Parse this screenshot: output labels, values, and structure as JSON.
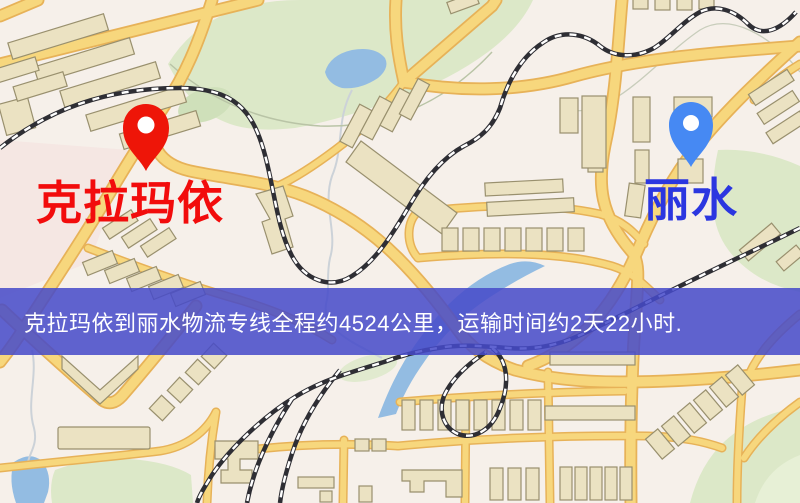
{
  "banner": {
    "text": "克拉玛依到丽水物流专线全程约4524公里，运输时间约2天22小时.",
    "bg_color": "#464aca",
    "text_color": "#ffffff"
  },
  "route": {
    "origin": "克拉玛依",
    "destination": "丽水",
    "distance_text": "约4524公里",
    "duration_text": "约2天22小时"
  },
  "pins": {
    "origin": {
      "label": "克拉玛依",
      "color": "#ee1508",
      "label_color": "#f20c0c"
    },
    "destination": {
      "label": "丽水",
      "color": "#4689f3",
      "label_color": "#2b36e0"
    }
  },
  "map_palette": {
    "background": "#f6f0ea",
    "park_green": "#dce8c8",
    "water_blue": "#93bce2",
    "road_fill": "#f7d77d",
    "road_casing": "#e7b258",
    "building_fill": "#ebe2c2",
    "building_stroke": "#99906e",
    "railway_dark": "#2e2e34"
  }
}
